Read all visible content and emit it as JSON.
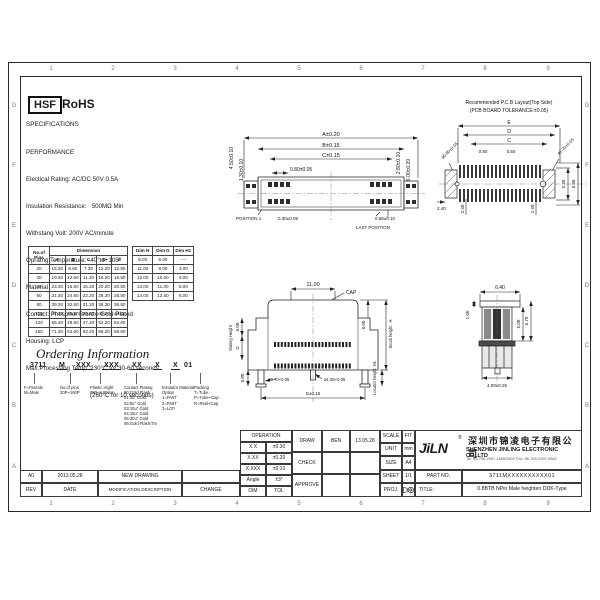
{
  "ink": "#1b1b1b",
  "frame": {
    "zones_top": [
      "1",
      "2",
      "3",
      "4",
      "5",
      "6",
      "7",
      "8",
      "9"
    ],
    "zones_bottom": [
      "1",
      "2",
      "3",
      "4",
      "5",
      "6",
      "7",
      "8",
      "9"
    ],
    "zones_left": [
      "G",
      "F",
      "E",
      "D",
      "C",
      "B",
      "A"
    ],
    "zones_right": [
      "G",
      "F",
      "E",
      "D",
      "C",
      "B",
      "A"
    ]
  },
  "logo": {
    "hsf": "HSF",
    "rohs": "RoHS"
  },
  "specs": {
    "title": "SPECIFICATIONS",
    "lines": [
      "PERFORMANCE",
      "Electical Rating: AC/DC 50V 0.5A",
      "Insulation Resistance:   500MΩ Min",
      "Withstang Volt: 200V AC/minute",
      "Opratng Temperature: -40°to+105°",
      "Material",
      "Contact: Phosphor Bronze Gold-Plated",
      "Housing: LCP",
      "Max.Processing Temp: 230°C for 30-60 seconds",
      "(260°C for 10 seconds)"
    ]
  },
  "pin_table": {
    "col0": "No.of Pins",
    "group": "Dimension",
    "cols": [
      "A",
      "B",
      "C",
      "D",
      "E"
    ],
    "rows": [
      [
        "20",
        "15.30",
        "8.60",
        "7.20",
        "12.20",
        "12.80"
      ],
      [
        "30",
        "19.30",
        "12.60",
        "11.20",
        "16.20",
        "16.80"
      ],
      [
        "40",
        "23.30",
        "16.60",
        "15.20",
        "20.20",
        "20.80"
      ],
      [
        "60",
        "31.30",
        "24.60",
        "23.20",
        "28.20",
        "28.80"
      ],
      [
        "80",
        "39.30",
        "32.60",
        "31.20",
        "36.20",
        "36.80"
      ],
      [
        "100",
        "47.30",
        "40.60",
        "39.20",
        "44.20",
        "44.80"
      ],
      [
        "120",
        "55.30",
        "48.60",
        "47.20",
        "52.20",
        "52.80"
      ],
      [
        "160",
        "71.30",
        "64.60",
        "63.20",
        "68.20",
        "68.80"
      ]
    ]
  },
  "height_table": {
    "cols": [
      "Dim H",
      "Dim G",
      "Dim H1"
    ],
    "rows": [
      [
        "8.00",
        "6.00",
        "----"
      ],
      [
        "11.00",
        "9.00",
        "3.00"
      ],
      [
        "12.00",
        "10.00",
        "4.00"
      ],
      [
        "13.00",
        "11.00",
        "5.00"
      ],
      [
        "14.00",
        "12.00",
        "6.00"
      ]
    ]
  },
  "ordering": {
    "title": "Ordering Information",
    "code": [
      "3711",
      "M",
      "XXX",
      "XXX",
      "XX",
      "X",
      "X",
      "01"
    ],
    "legends": [
      {
        "lines": [
          "F=Female",
          "M=Male"
        ]
      },
      {
        "lines": [
          "No.of pins",
          "20P~160P"
        ]
      },
      {
        "lines": [
          "Plastic Hight",
          "080=8.00mm"
        ]
      },
      {
        "lines": [
          "Contact Plating",
          "00:Gold Flash",
          "01:3u\" Gold",
          "02:5u\" Gold",
          "03:10u\" Gold",
          "04:15u\" Gold",
          "05:30u\" Gold",
          "06:Gold Flash/Tin"
        ]
      },
      {
        "lines": [
          "Insulator Material",
          "Option",
          "1=PA9T",
          "2=PA6T",
          "3=LCP"
        ]
      },
      {
        "lines": [
          "Packing",
          "T=Tube",
          "P=Tube+Cap",
          "R=Reel+Cap"
        ]
      }
    ]
  },
  "views": {
    "top": {
      "dim_a": "A±0.20",
      "dim_b": "B±0.15",
      "dim_c": "C±0.15",
      "pitch": "0.80±0.05",
      "left1": "4.50±0.10",
      "left2": "1.30±0.10",
      "right1": "2.80±0.10",
      "right2": "6.00±0.20",
      "bot1": "0.30±0.05",
      "bot2": "0.65±0.10",
      "pos1": "POSITION 1",
      "pos_last": "LAST POSITION"
    },
    "pcb": {
      "title1": "Recommended P.C.B Layout(Top Side)",
      "title2": "(PCB BOARD TOLERANCE:±0.05)",
      "dim_e": "E",
      "dim_d": "D",
      "dim_c": "C",
      "p1": "0.80",
      "p2": "0.50",
      "hole_l": "ø0.80±0.05",
      "hole_r": "ø1.20±0.05",
      "w1": "2.40",
      "w2": "2.40",
      "w3": "2.40",
      "h1": "5.40",
      "h2": "6.95"
    },
    "front": {
      "top": "11.00",
      "cap": "CAP",
      "left1": "6.00",
      "left2": "G",
      "mating": "Mating Height",
      "right1": "8.00",
      "stock": "Stock height",
      "stock_h": "H",
      "locator": "Locator height",
      "locator_h": "H1",
      "bot_left": "0.80",
      "pin1": "ø0.70+0.05",
      "pin2": "ø1.05+0.05",
      "bot": "D±0.15"
    },
    "side": {
      "top": "6.40",
      "left": "1.00",
      "r1": "5.00",
      "r2": "5.70",
      "bot": "4.00±0.25"
    }
  },
  "titleblock": {
    "operation": {
      "title": "OPERATION",
      "rows": [
        [
          "X.X",
          "±0.30"
        ],
        [
          "X.XX",
          "±0.20"
        ],
        [
          "X.XXX",
          "±0.10"
        ],
        [
          "Angle",
          "±3°"
        ]
      ],
      "dim": "DIM",
      "tol": "TOL"
    },
    "sign": {
      "draw": "DRAW",
      "draw_name": "BEN",
      "draw_date": "13.05.28",
      "check": "CHECK",
      "approve": "APPROVE"
    },
    "meta": {
      "scale": "SCALE",
      "scale_v": "FIT",
      "unit": "UNIT",
      "unit_v": "mm",
      "size": "SIZE",
      "size_v": "A4",
      "sheet": "SHEET",
      "sheet_v": "1/1",
      "proj": "PROJ.",
      "proj_icon": "third-angle-projection-symbol"
    },
    "company": {
      "logo": "JiLN",
      "reg": "®",
      "cn": "深圳市锦凌电子有限公司",
      "en": "SHENZHEN JINLING ELECTRONIC CO.,LTD",
      "contact": "Tel: 86-755-2997-1808/3902   Fax: 86-755-2997-0982"
    },
    "part_label": "PART NO.",
    "part_no": "3711MXXXXXXXXXX01",
    "title_label": "TITLE:",
    "title": "0.8BTB NPin Male heighten DDK-Type",
    "rev_table": {
      "rev": "A0",
      "date": "2013.05.28",
      "desc": "NEW DRAWING",
      "rev_h": "REV",
      "date_h": "DATE",
      "desc_h": "MODIFICATION DESCRIPTION",
      "change_h": "CHANGE"
    }
  }
}
